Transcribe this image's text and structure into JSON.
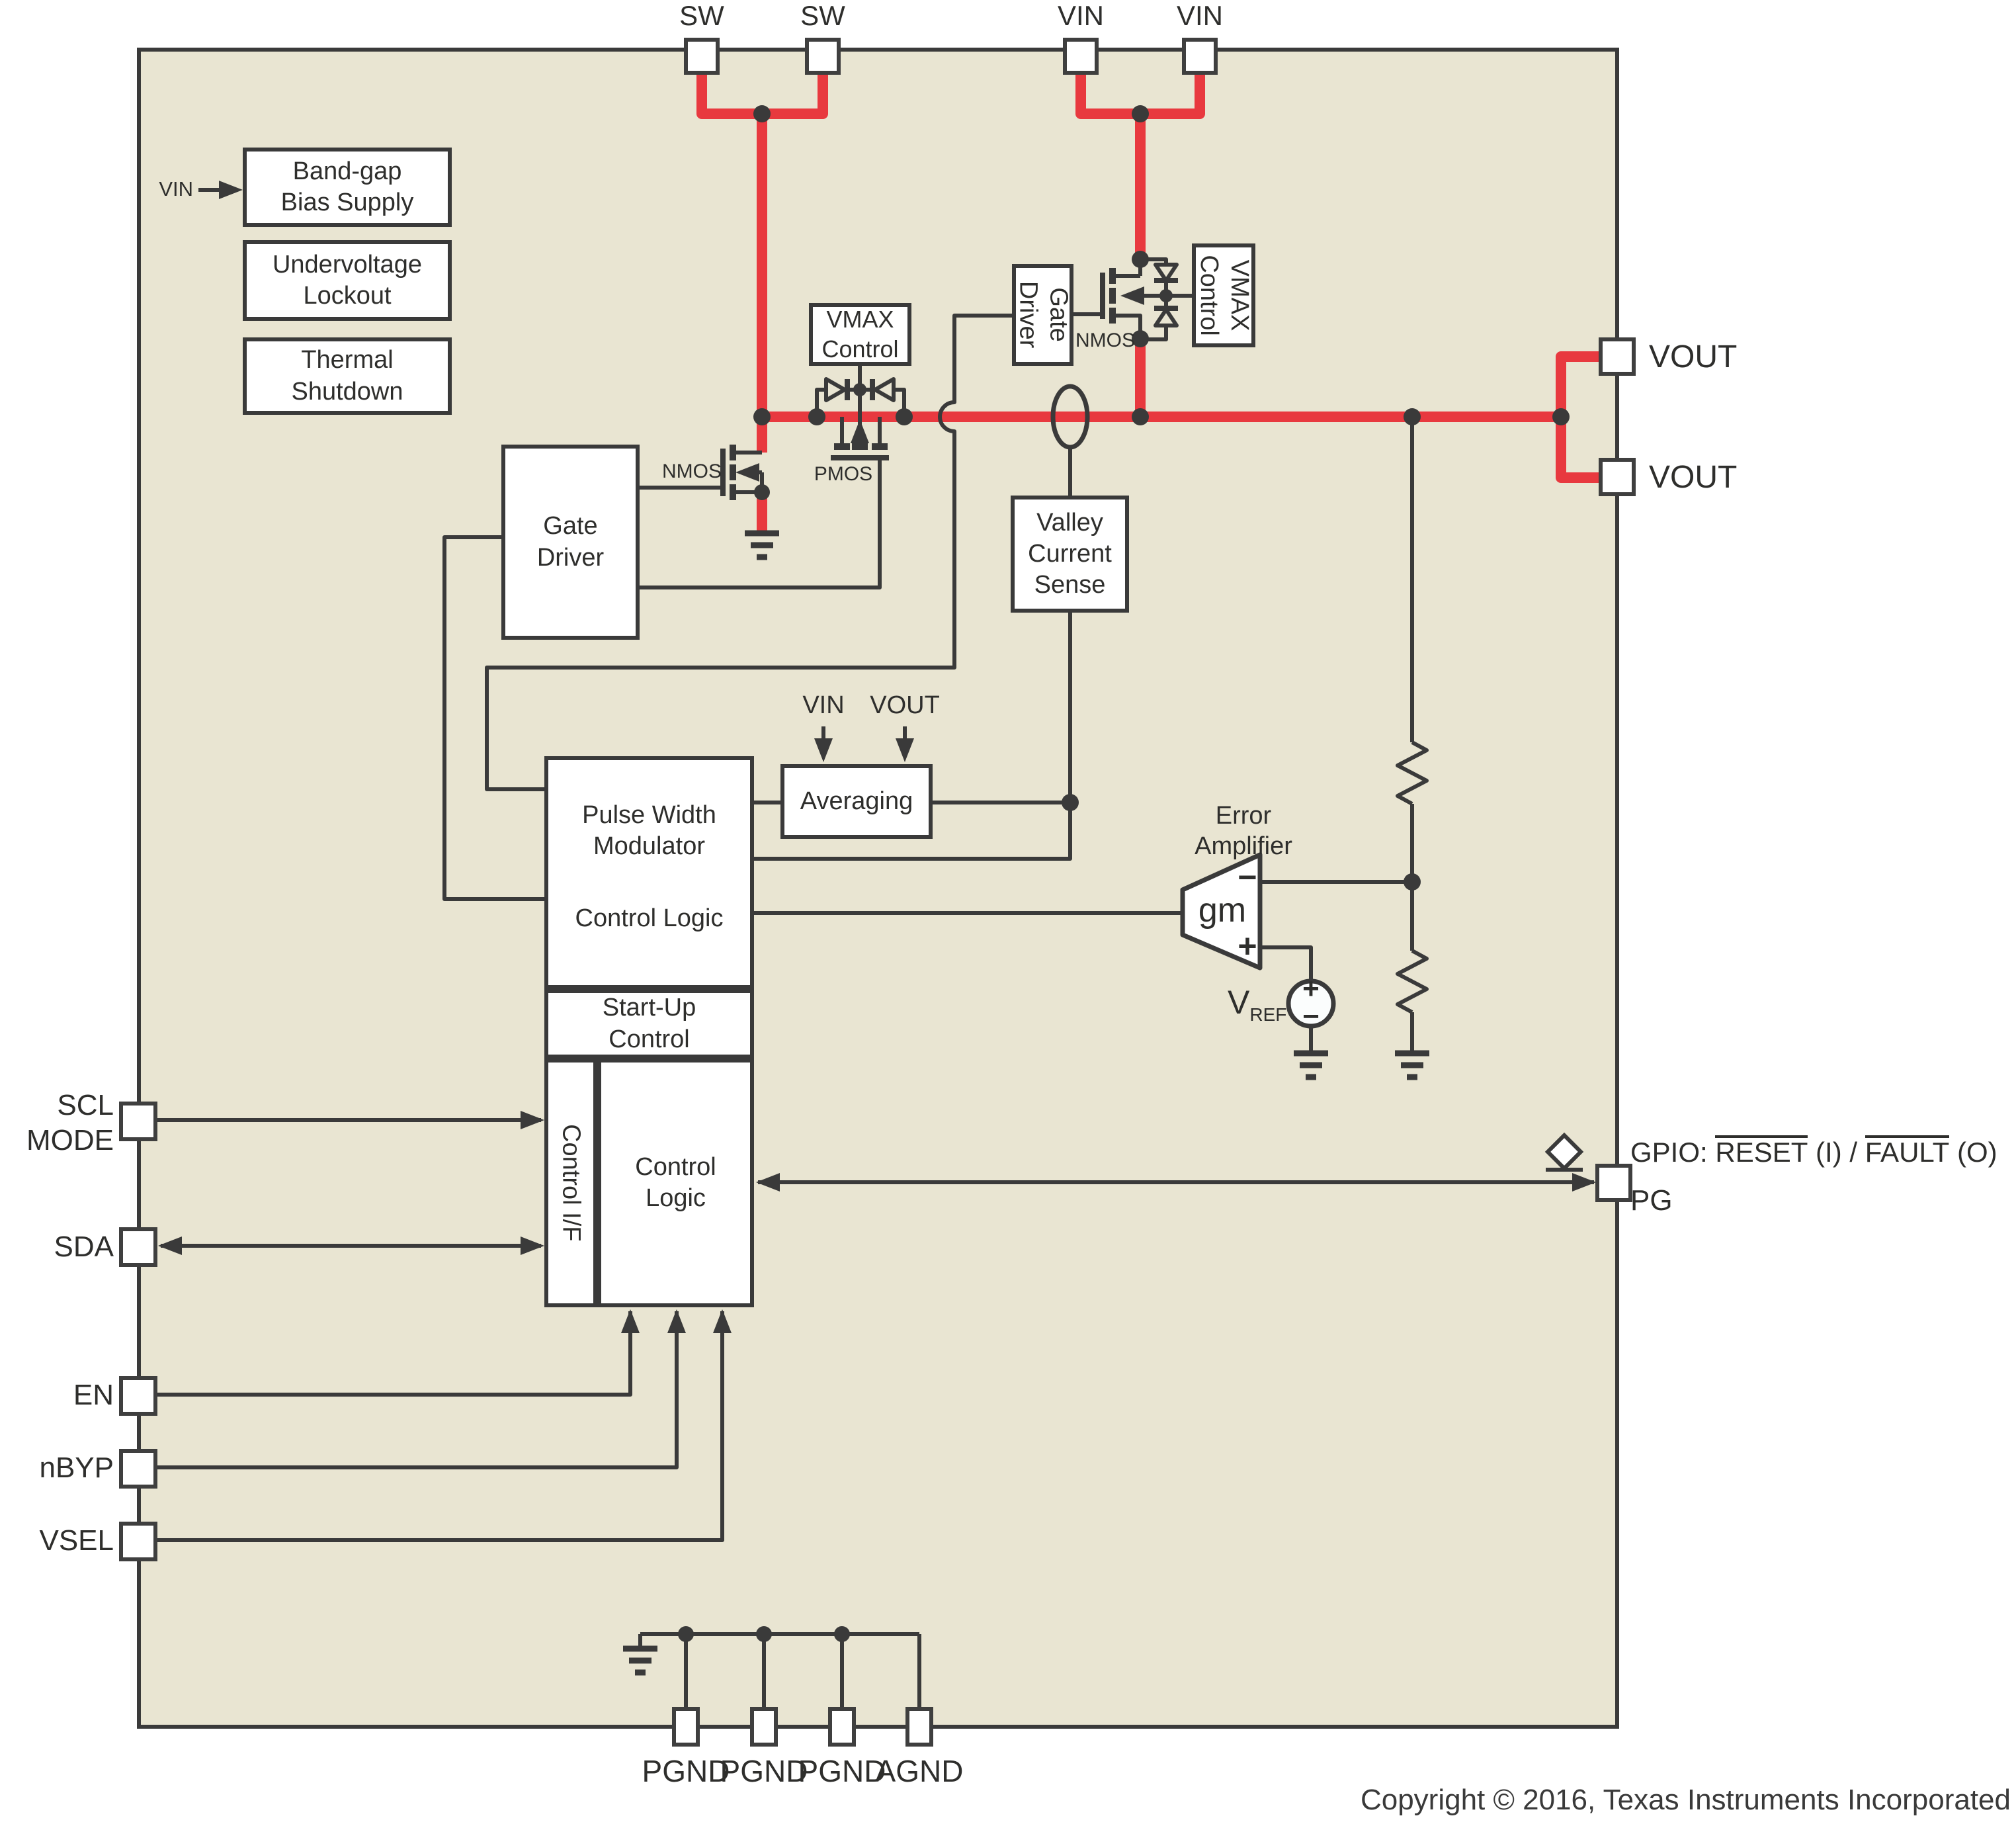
{
  "colors": {
    "chip_fill": "#e9e5d2",
    "line": "#3a3a3a",
    "power_red": "#e8393f",
    "pin_fill": "#ffffff"
  },
  "pins": {
    "top": [
      "SW",
      "SW",
      "VIN",
      "VIN"
    ],
    "right": [
      "VOUT",
      "VOUT"
    ],
    "left": {
      "vin": "VIN",
      "scl": "SCL",
      "mode": "MODE",
      "sda": "SDA",
      "en": "EN",
      "nbyp": "nBYP",
      "vsel": "VSEL"
    },
    "bottom": [
      "PGND",
      "PGND",
      "PGND",
      "AGND"
    ],
    "gpio": {
      "prefix": "GPIO: ",
      "reset": "RESET",
      "mid": " (I) / ",
      "fault": "FAULT",
      "suffix": " (O)",
      "pg": "PG"
    }
  },
  "blocks": {
    "bandgap": {
      "l1": "Band-gap",
      "l2": "Bias Supply"
    },
    "uvlo": {
      "l1": "Undervoltage",
      "l2": "Lockout"
    },
    "thermal": {
      "l1": "Thermal",
      "l2": "Shutdown"
    },
    "gate_driver_left": {
      "l1": "Gate",
      "l2": "Driver"
    },
    "gate_driver_right": {
      "l1": "Gate",
      "l2": "Driver"
    },
    "vmax_right": {
      "l1": "VMAX",
      "l2": "Control"
    },
    "vmax_mid": {
      "l1": "VMAX",
      "l2": "Control"
    },
    "valley": {
      "l1": "Valley",
      "l2": "Current",
      "l3": "Sense"
    },
    "averaging": {
      "label": "Averaging"
    },
    "pwm": {
      "l1": "Pulse Width",
      "l2": "Modulator",
      "l3": "Control Logic"
    },
    "startup": {
      "l1": "Start-Up",
      "l2": "Control"
    },
    "control_if": {
      "label": "Control I/F"
    },
    "control_logic": {
      "l1": "Control",
      "l2": "Logic"
    }
  },
  "transistors": {
    "nmos_left": "NMOS",
    "nmos_right": "NMOS",
    "pmos": "PMOS"
  },
  "averaging_inputs": {
    "vin": "VIN",
    "vout": "VOUT"
  },
  "amplifier": {
    "title_l1": "Error",
    "title_l2": "Amplifier",
    "gm": "gm",
    "minus": "−",
    "plus": "+",
    "vref_v": "V",
    "vref_sub": "REF",
    "src_plus": "+",
    "src_minus": "−"
  },
  "footer": {
    "copyright": "Copyright © 2016, Texas Instruments Incorporated"
  }
}
